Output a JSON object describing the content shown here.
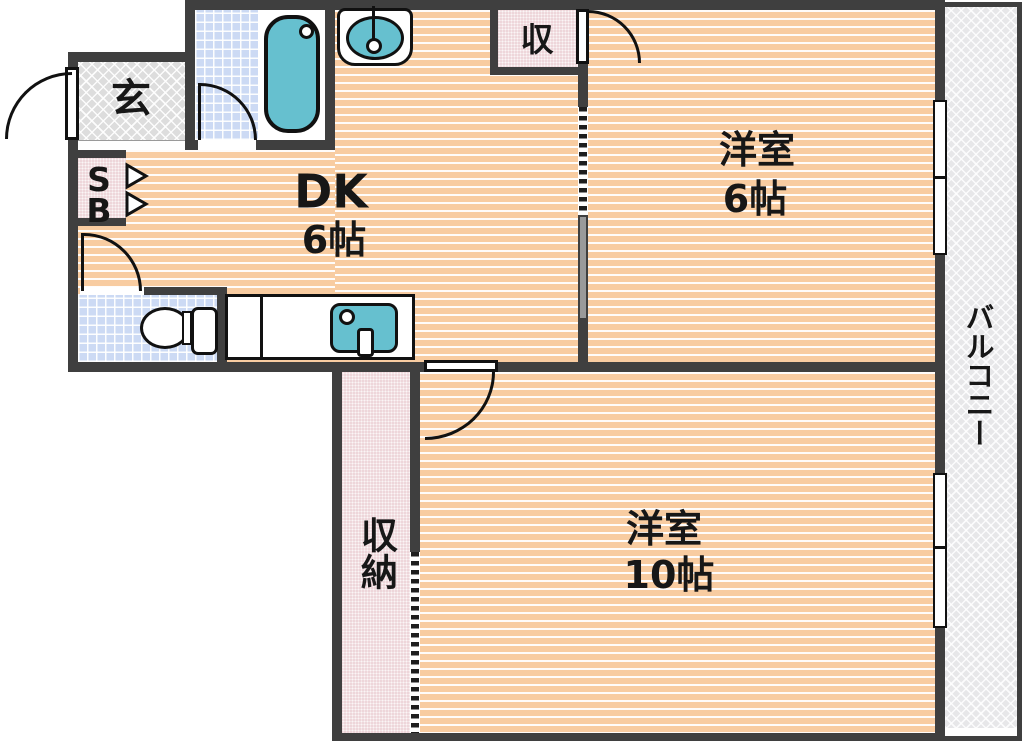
{
  "floorplan": {
    "title": "apartment-floorplan",
    "entrance": {
      "label": "玄"
    },
    "dk": {
      "name": "DK",
      "size": "6帖"
    },
    "room6": {
      "name": "洋室",
      "size": "6帖"
    },
    "room10": {
      "name": "洋室",
      "size": "10帖"
    },
    "closet_top": {
      "label": "収"
    },
    "storage": {
      "label": "収納"
    },
    "balcony": {
      "label": "バルコニー"
    },
    "shoebox": {
      "s": "S",
      "b": "B"
    },
    "fixtures": [
      "bathtub",
      "washbasin",
      "toilet",
      "kitchen-sink"
    ],
    "colors": {
      "wall": "#3f3f3f",
      "floor_peach": "#f8cca1",
      "closet_pink": "#eed6da",
      "tile_blue": "#ccdaf4",
      "fixture_teal": "#66c0cf",
      "entrance_gray": "#dddddd",
      "balcony_gray": "#e7e7e9",
      "line": "#111111"
    }
  }
}
